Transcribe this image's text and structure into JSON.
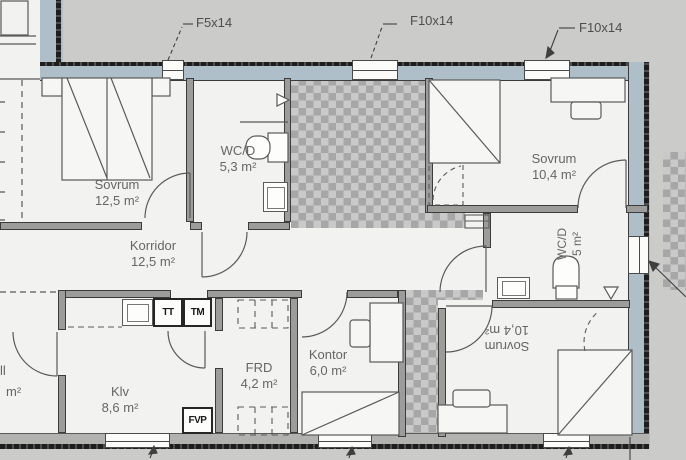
{
  "plan": {
    "window_labels": {
      "f5": "F5x14",
      "f10a": "F10x14",
      "f10b": "F10x14"
    },
    "rooms": {
      "sovrum_nw": {
        "name": "Sovrum",
        "area": "12,5 m²"
      },
      "wcd_nw": {
        "name": "WC/D",
        "area": "5,3 m²"
      },
      "sovrum_ne": {
        "name": "Sovrum",
        "area": "10,4 m²"
      },
      "korridor": {
        "name": "Korridor",
        "area": "12,5 m²"
      },
      "hall": {
        "name_fragment": "ll",
        "area_fragment": "m²"
      },
      "klv": {
        "name": "Klv",
        "area": "8,6 m²"
      },
      "frd": {
        "name": "FRD",
        "area": "4,2 m²"
      },
      "kontor": {
        "name": "Kontor",
        "area": "6,0 m²"
      },
      "sovrum_se": {
        "name": "Sovrum",
        "area": "10,4 m²"
      },
      "wcd_e": {
        "name": "WC/D",
        "area": "5 m²"
      }
    },
    "appliances": {
      "tt": "TT",
      "tm": "TM",
      "fvp": "FVP"
    },
    "colors": {
      "exterior_wall": "#aebfca",
      "exterior_ground": "#cbcbc9",
      "interior_wall": "#9c9c9a",
      "checker_dark": "#a7a7a7",
      "checker_light": "#c9c9c9",
      "label_text": "#666666"
    }
  }
}
